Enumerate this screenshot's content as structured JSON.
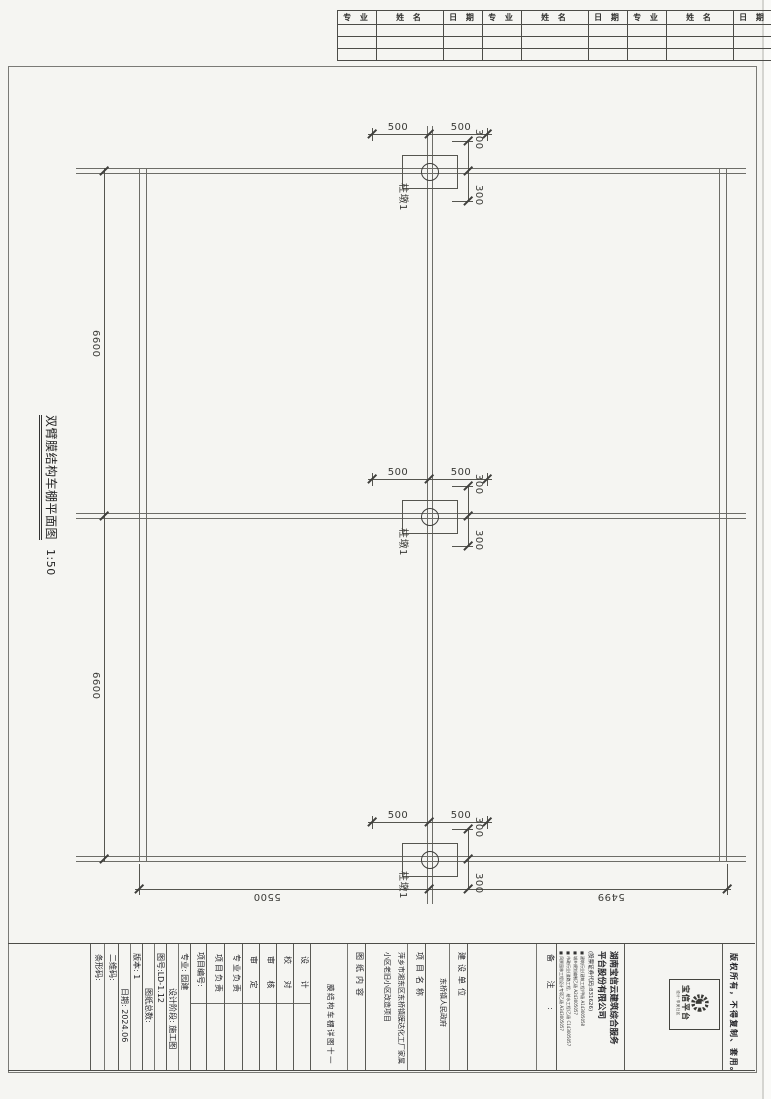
{
  "sheet": {
    "paper_color": "#f5f5f2",
    "line_color": "#6d6d68",
    "frame_color": "#7a7a76"
  },
  "signature_table": {
    "headers": [
      "专 业",
      "姓 名",
      "日 期",
      "专 业",
      "姓 名",
      "日 期",
      "专 业",
      "姓 名",
      "日 期"
    ]
  },
  "plan": {
    "title": "双臂膜结构车棚平面图",
    "scale": "1:50",
    "pier_label": "柱墩1",
    "dim_bay_upper": "6600",
    "dim_bay_lower": "6600",
    "dim_bottom_left": "5500",
    "dim_bottom_right": "5499",
    "dim_half_left": "500",
    "dim_half_right": "500",
    "dim_off_top": "300",
    "dim_off_bottom": "300"
  },
  "title_block": {
    "qr_label": "二维码:",
    "barcode_label": "条形码:",
    "version_label": "版本:",
    "version_value": "1",
    "date_label": "日期:",
    "date_value": "2024.06",
    "sheet_no": "图号:LD-1.12",
    "sheet_total": "图纸总数:",
    "discipline": "专业: 园建",
    "stage": "设计阶段: 施工图",
    "project_no_label": "项目编号:",
    "roles": [
      "设 计",
      "校 对",
      "审 核",
      "审 定",
      "专业负责",
      "项目负责"
    ],
    "content_label": "图纸内容",
    "content_value": "膜结构车棚详图十一",
    "project_label": "项目名称",
    "project_line1": "萍乡市湘东区东桥镇膜达化工厂家属",
    "project_line2": "小区老旧小区改造项目",
    "owner_label": "建设单位",
    "owner_value": "东桥镇人民政府",
    "notes_label": "备 注 :",
    "company_name1": "湖南宝信云建筑综合服务",
    "company_name2": "平台股份有限公司",
    "company_code": "(股票证券代码:831626)",
    "certs": [
      "建筑行业(建筑工程)甲级 A143005058",
      "城乡规划编制乙级 A243005057",
      "市政行业(道路工程、给水工程)乙级 C143005057",
      "风景园林工程设计专项乙级 A343005057"
    ],
    "logo_name": "宝信平台",
    "logo_tagline": "设计·享美社区",
    "copyright": "版权所有，不得复制、套用。"
  }
}
